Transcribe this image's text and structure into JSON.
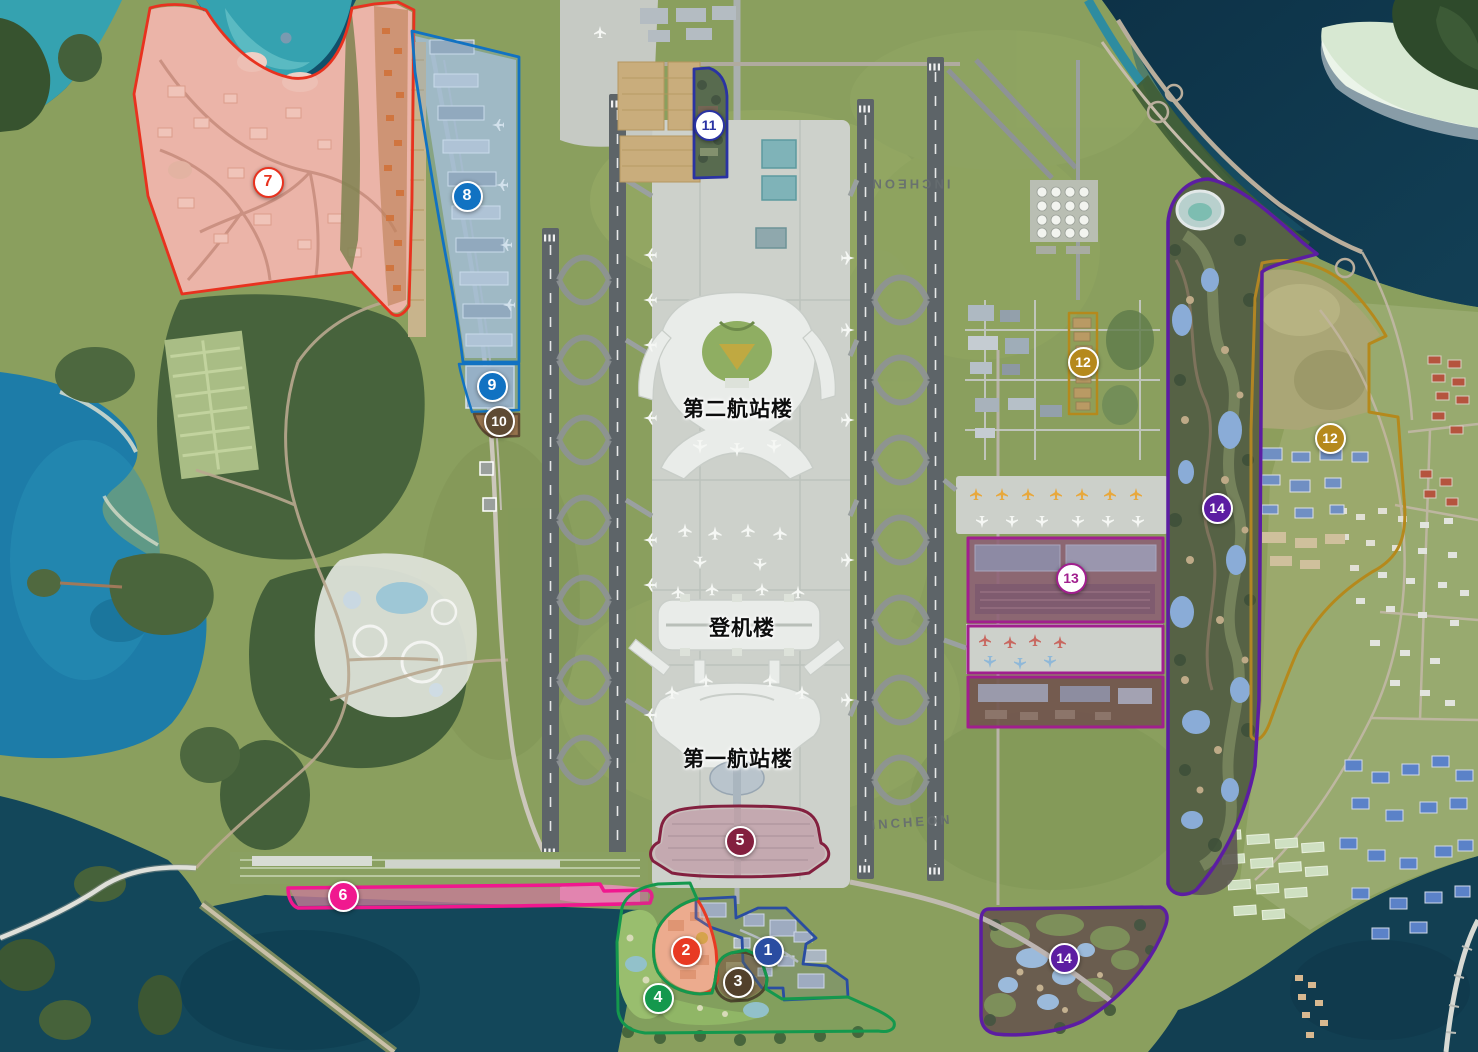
{
  "map": {
    "description": "Satellite master-plan map of Incheon International Airport with numbered development zones",
    "labels": [
      {
        "id": "terminal2",
        "text": "第二航站楼",
        "x": 738,
        "y": 408,
        "rotate": 0,
        "kind": "terminal"
      },
      {
        "id": "concourse",
        "text": "登机楼",
        "x": 742,
        "y": 627,
        "rotate": 0,
        "kind": "terminal"
      },
      {
        "id": "terminal1",
        "text": "第一航站楼",
        "x": 738,
        "y": 758,
        "rotate": 0,
        "kind": "terminal"
      },
      {
        "id": "runway-name-north",
        "text": "INCHEON",
        "x": 910,
        "y": 184,
        "rotate": 180,
        "kind": "runway"
      },
      {
        "id": "runway-name-south",
        "text": "INCHEON",
        "x": 912,
        "y": 822,
        "rotate": -4,
        "kind": "runway"
      }
    ],
    "zones": [
      {
        "id": "1",
        "num": "1",
        "style": "filled",
        "color": "#2a4da1",
        "x": 768,
        "y": 951
      },
      {
        "id": "2",
        "num": "2",
        "style": "filled",
        "color": "#e83a23",
        "x": 686,
        "y": 951
      },
      {
        "id": "3",
        "num": "3",
        "style": "filled",
        "color": "#52402b",
        "x": 738,
        "y": 982
      },
      {
        "id": "4",
        "num": "4",
        "style": "filled",
        "color": "#14984d",
        "x": 658,
        "y": 998
      },
      {
        "id": "5",
        "num": "5",
        "style": "filled",
        "color": "#83203f",
        "x": 740,
        "y": 841
      },
      {
        "id": "6",
        "num": "6",
        "style": "filled",
        "color": "#f0188f",
        "x": 343,
        "y": 896
      },
      {
        "id": "7",
        "num": "7",
        "style": "outline",
        "color": "#e8321f",
        "x": 268,
        "y": 182
      },
      {
        "id": "8",
        "num": "8",
        "style": "filled",
        "color": "#1172c2",
        "x": 467,
        "y": 196
      },
      {
        "id": "9",
        "num": "9",
        "style": "filled",
        "color": "#1172c2",
        "x": 492,
        "y": 386
      },
      {
        "id": "10",
        "num": "10",
        "style": "filled",
        "color": "#5e4a33",
        "x": 499,
        "y": 421
      },
      {
        "id": "11",
        "num": "11",
        "style": "outline",
        "color": "#2a33a3",
        "x": 709,
        "y": 125
      },
      {
        "id": "12a",
        "num": "12",
        "style": "filled",
        "color": "#b5891c",
        "x": 1083,
        "y": 362
      },
      {
        "id": "12b",
        "num": "12",
        "style": "filled",
        "color": "#b5891c",
        "x": 1330,
        "y": 438
      },
      {
        "id": "13",
        "num": "13",
        "style": "outline",
        "color": "#a11f8e",
        "x": 1071,
        "y": 578
      },
      {
        "id": "14a",
        "num": "14",
        "style": "filled",
        "color": "#5c1da2",
        "x": 1217,
        "y": 508
      },
      {
        "id": "14b",
        "num": "14",
        "style": "filled",
        "color": "#5c1da2",
        "x": 1064,
        "y": 958
      }
    ],
    "palette": {
      "ocean_deep": "#0f3a50",
      "ocean_mid": "#11506a",
      "bay": "#1d7ca8",
      "turquoise": "#35a2b0",
      "grass": "#8a9f5e",
      "forest": "#47633c",
      "apron": "#cdd1cb",
      "runway": "#5d6468",
      "terminal": "#e9ece9"
    }
  }
}
